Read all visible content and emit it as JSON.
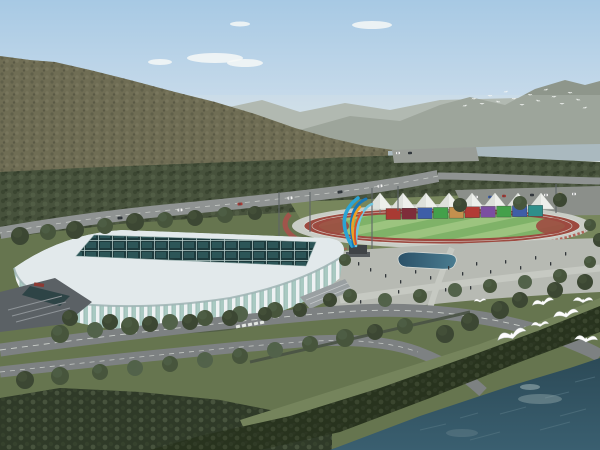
{
  "scene": {
    "type": "aerial-architectural-rendering",
    "description": "Bird's-eye rendering of a white lattice-facade stadium beside an athletics track with white canopy tents, a colorful flame sculpture, plazas, tree-lined roads, a river in the foreground with flying gulls, forested hills and a distant river under a hazy blue sky"
  },
  "palette": {
    "sky_top": "#a7c9e4",
    "sky_mid": "#c6daea",
    "sky_horizon": "#e4e8e3",
    "cloud": "#f6f8f7",
    "mtn_far": "#a3aaa0",
    "mtn_mid": "#8e968b",
    "mtn_near": "#6f6d54",
    "mtn_tex_dark": "#5d5c47",
    "mtn_tex_light": "#7b785f",
    "river_far": "#aab9bf",
    "forest": "#47523c",
    "forest_dark": "#39442f",
    "forest_light": "#566349",
    "grass_mid": "#77865c",
    "grass_fore": "#66754f",
    "grass_bank": "#75845c",
    "road": "#7d8182",
    "road_far": "#8f9392",
    "road_line": "#d3d7d2",
    "plaza": "#b7bab3",
    "plaza_light": "#c6c9c2",
    "pale_ring": "#c9cdc6",
    "track_red": "#9d4a40",
    "field_green_a": "#9cc47f",
    "field_green_b": "#7fb268",
    "tent_white": "#edefeb",
    "tent_shade": "#d2d6d1",
    "roof": "#e2e9eb",
    "rib_white": "#eef2f3",
    "glass_teal": "#a9c9c2",
    "skylight_dark": "#1d3a3c",
    "skylight_line": "#b9cdcb",
    "entrance_grey": "#5b6165",
    "water_top": "#2c4a57",
    "water_bottom": "#3a5f70",
    "shore_trees": "#28331e",
    "tree_dark": "#3c4733",
    "tree_mid": "#47553c",
    "tree_light": "#52624a",
    "gull_white": "#fdfdfc",
    "people_dark": "#31363a",
    "sculpture_blue": "#2ba4d4",
    "sculpture_blue_dark": "#1877b8",
    "sculpture_blue_light": "#6fc6e2",
    "sculpture_orange": "#f0a122",
    "sculpture_red": "#d9532b",
    "pedestal": "#3f4346"
  },
  "elements": {
    "clouds": {
      "count": 5
    },
    "tents": {
      "count": 8,
      "color": "#edefeb"
    },
    "wall_segments": {
      "colors": [
        "#a83a33",
        "#7e2d3a",
        "#3e5ea7",
        "#44a04a",
        "#c4904e",
        "#b23b35",
        "#7b4ea1",
        "#44a04a",
        "#3e5ea7",
        "#2f8f8a"
      ]
    },
    "gulls": {
      "count": 7,
      "color": "#fdfdfc"
    },
    "distant_flock": {
      "count": 16,
      "color": "#f6f8f6"
    },
    "vehicles": {
      "count": 32,
      "colors": [
        "#f2f2f0",
        "#ab3a33",
        "#2e3438",
        "#d8d8d4",
        "#3f5fa7",
        "#8c9094",
        "#c7b15a"
      ]
    },
    "people": {
      "count": 20,
      "color": "#31363a"
    },
    "trees": {
      "count": 56
    }
  }
}
